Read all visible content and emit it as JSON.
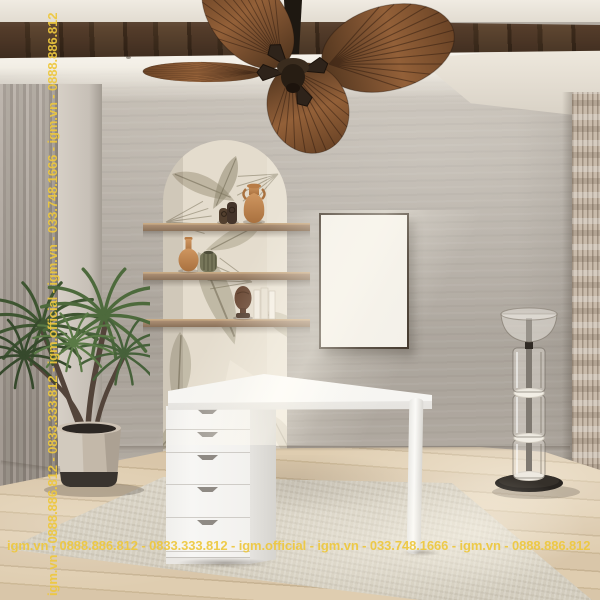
{
  "watermarks": {
    "color": "#EEC83E",
    "bottom": "igm.vn - 0888.886.812 - 0833.333.812 - igm.official - igm.vn - 033.748.1666 - igm.vn - 0888.886.812",
    "left_vertical": "igm.vn - 0888.886.812 - 0833.333.812 - igm.official - igm.vn - 033.748.1666 - igm.vn - 0888.886.812"
  },
  "poster": {
    "brand": "IGM",
    "subtitle": "OFFICIAL",
    "grid_rows": 4,
    "grid_cols": 3,
    "background": "#F3F0E9",
    "text_color": "#1D1A16",
    "frame_color": "#41362B"
  },
  "palette": {
    "wall": "#B3ACA3",
    "ceiling": "#EFEAE1",
    "beam_wood": "#4A3525",
    "curtain": "#A49B92",
    "wallpaper": "#E4DCCD",
    "shelf_wood": "#9A8168",
    "terracotta": "#C08A55",
    "plant_green": "#4C643B",
    "desk_white": "#F6F5F3",
    "floor_wood": "#D9C6A9",
    "rug": "#D6D0C2",
    "lamp_base": "#282420"
  }
}
